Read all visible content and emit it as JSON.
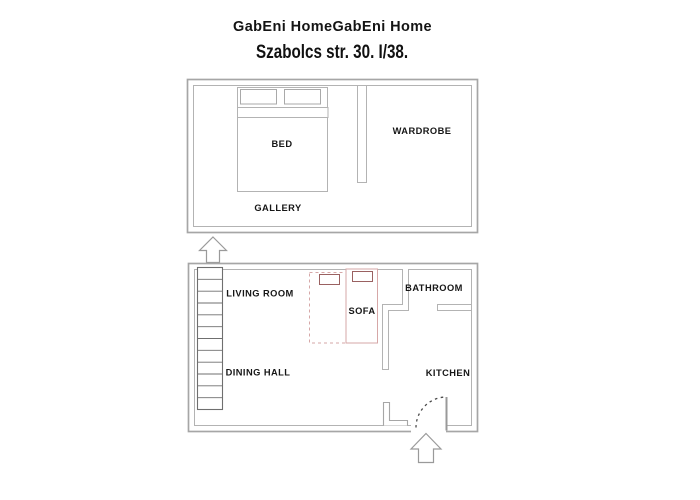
{
  "header": {
    "title": "GabEni HomeGabEni Home",
    "subtitle": "Szabolcs str. 30. I/38."
  },
  "upper_floor": {
    "labels": {
      "bed": "BED",
      "wardrobe": "WARDROBE",
      "gallery": "GALLERY"
    }
  },
  "lower_floor": {
    "labels": {
      "living_room": "LIVING ROOM",
      "sofa": "SOFA",
      "bathroom": "BATHROOM",
      "dining_hall": "DINING HALL",
      "kitchen": "KITCHEN"
    }
  },
  "icons": {
    "stairs_arrow": "up-arrow",
    "entrance_arrow": "up-arrow"
  },
  "colors": {
    "wall_outer": "#a6a6a6",
    "wall_inner": "#b3b3b3",
    "stairs_outline": "#6f6f6f",
    "sofa_outline": "#d6a7a7",
    "pillow_outline": "#9a6161",
    "door_arc": "#4a4a4a",
    "arrow_outline": "#9a9a9a",
    "text": "#161616"
  }
}
